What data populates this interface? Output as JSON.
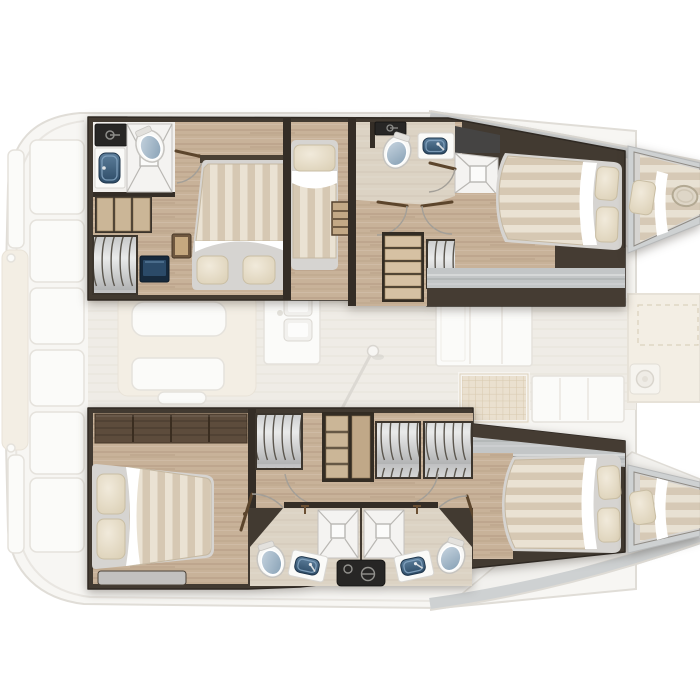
{
  "document": {
    "type": "boat-floor-plan",
    "subject": "catamaran-interior-layout",
    "view": "top-down",
    "orientation": {
      "bow": "right",
      "stern": "left"
    },
    "visible_text": []
  },
  "palette": {
    "pageBg": "#ffffff",
    "deckFill": "#f7f6f3",
    "deckLine": "#dfdcd6",
    "saloonFloor": "#efece6",
    "faintWhite": "#fbfbf9",
    "faintBeige": "#f3eee4",
    "faintLine": "#e5e2dc",
    "grayDeck": "#ced1d2",
    "grayWalk": "#c3c6c7",
    "wall": "#423a31",
    "wallDark": "#342d26",
    "wardrobe": "#5d4c3c",
    "wood": "#c8b299",
    "paleFloor": "#dcd3c4",
    "bathFloor": "#f1efec",
    "blackCounter": "#272625",
    "navySink": "#2d4b66",
    "toiletLid": "#9db4c7",
    "lockerGray": "#d6d7d7",
    "lockerLine": "#5b564e",
    "mattress": "#d6d4d1",
    "duvetLight": "#eae2d3",
    "duvetDark": "#d6c8b3",
    "pillow": "#ece4d2",
    "pillowEdge": "#c9bea4",
    "stairWood": "#d6c1a3",
    "shelfWood": "#cbb697",
    "tvNavy": "#1e3a55",
    "doorLeaf": "#5c452c",
    "arcLine": "#a39f98",
    "bench": "#c2c1bf"
  },
  "vessel": {
    "hulls": [
      {
        "id": "port-hull",
        "position": "top",
        "rooms": [
          {
            "name": "aft-bathroom",
            "furniture": [
              "black-counter",
              "sink",
              "toilet",
              "shower",
              "door"
            ]
          },
          {
            "name": "aft-double-cabin",
            "furniture": [
              "double-bed",
              "pillow",
              "pillow",
              "shelf-unit",
              "hanging-locker",
              "tv-unit",
              "nightstand"
            ]
          },
          {
            "name": "single-berth-cabin",
            "furniture": [
              "single-bed",
              "pillow",
              "ladder"
            ]
          },
          {
            "name": "companionway",
            "furniture": [
              "stairs",
              "hanging-locker",
              "door",
              "door"
            ]
          },
          {
            "name": "mid-bathroom",
            "furniture": [
              "black-counter",
              "toilet",
              "sink",
              "shower",
              "door"
            ]
          },
          {
            "name": "forward-double-cabin",
            "furniture": [
              "double-bed",
              "pillow",
              "pillow"
            ]
          },
          {
            "name": "forepeak-berth",
            "furniture": [
              "single-berth",
              "pillow",
              "deck-hatch"
            ]
          }
        ]
      },
      {
        "id": "starboard-hull",
        "position": "bottom",
        "rooms": [
          {
            "name": "aft-double-cabin",
            "furniture": [
              "wardrobe",
              "double-bed",
              "pillow",
              "pillow",
              "bench",
              "door"
            ]
          },
          {
            "name": "companionway",
            "furniture": [
              "hanging-locker",
              "shelf-unit",
              "hanging-locker",
              "hanging-locker",
              "door",
              "door"
            ]
          },
          {
            "name": "port-side-bathroom",
            "furniture": [
              "toilet",
              "sink",
              "shower",
              "mixer-tap"
            ]
          },
          {
            "name": "center-console",
            "furniture": [
              "black-counter"
            ]
          },
          {
            "name": "starboard-side-bathroom",
            "furniture": [
              "shower",
              "sink",
              "toilet",
              "mixer-tap"
            ]
          },
          {
            "name": "forward-double-cabin",
            "furniture": [
              "double-bed",
              "pillow",
              "pillow"
            ]
          },
          {
            "name": "forepeak-berth",
            "furniture": [
              "single-berth",
              "pillow"
            ]
          }
        ]
      }
    ],
    "deck_features": [
      "stern-platform-steps",
      "cockpit-bench-panels",
      "saloon-table",
      "saloon-sofa",
      "galley-double-sink",
      "sliding-door-with-handle",
      "nav-cabinet",
      "deck-hatch-grid",
      "forward-cockpit-lounge",
      "forward-locker",
      "side-deck-gunwales"
    ]
  }
}
